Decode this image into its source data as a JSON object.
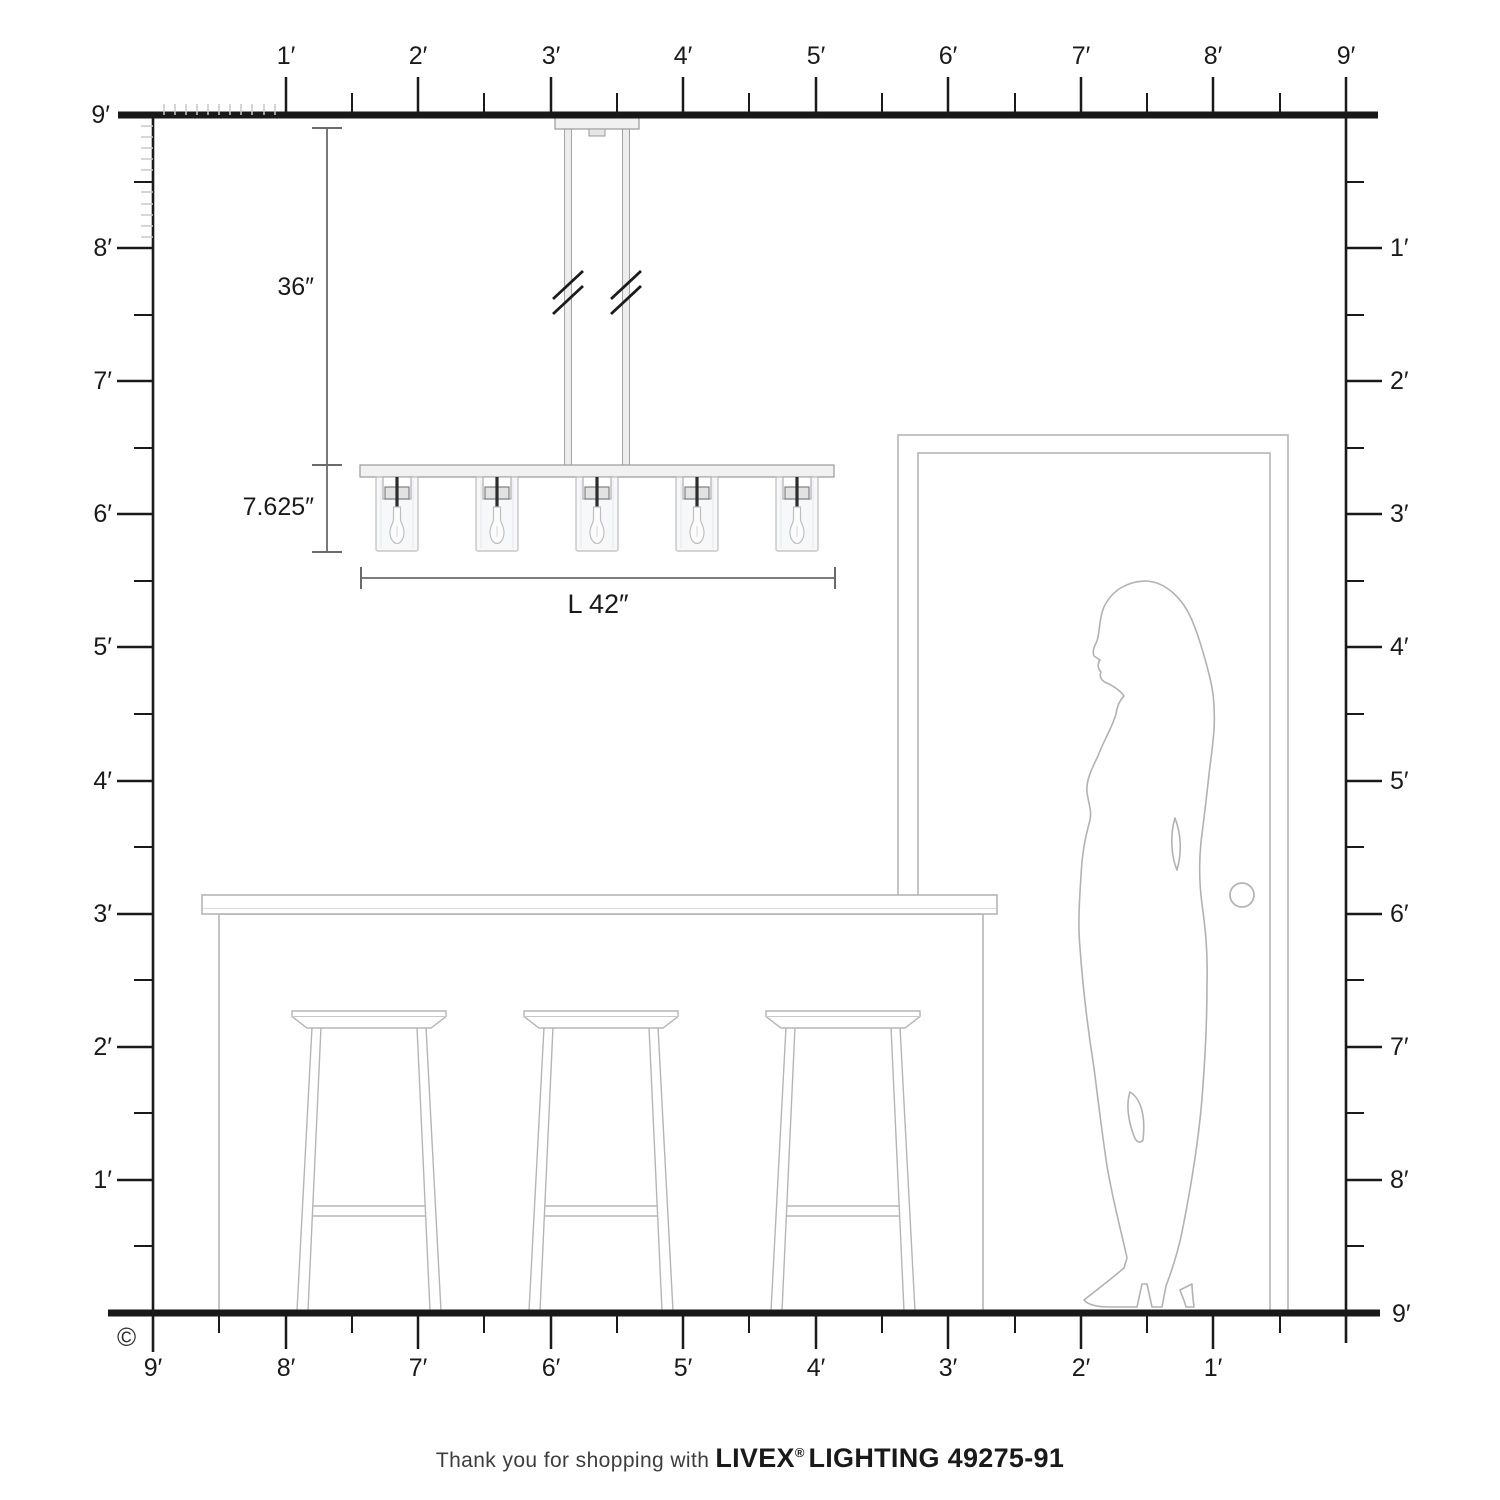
{
  "title": "Lighting fixture scale diagram",
  "rulers": {
    "unit": "feet",
    "max_feet": 9,
    "top": [
      "1′",
      "2′",
      "3′",
      "4′",
      "5′",
      "6′",
      "7′",
      "8′",
      "9′"
    ],
    "left": [
      "9′",
      "8′",
      "7′",
      "6′",
      "5′",
      "4′",
      "3′",
      "2′",
      "1′"
    ],
    "right": [
      "1′",
      "2′",
      "3′",
      "4′",
      "5′",
      "6′",
      "7′",
      "8′",
      "9′"
    ],
    "bottom": [
      "9′",
      "8′",
      "7′",
      "6′",
      "5′",
      "4′",
      "3′",
      "2′",
      "1′"
    ]
  },
  "fixture": {
    "type": "5-light linear chandelier",
    "lights": 5,
    "drop_label": "36″",
    "height_label": "7.625″",
    "length_label": "L 42″"
  },
  "scene": {
    "furniture": [
      "kitchen island",
      "bar stool",
      "bar stool",
      "bar stool",
      "door",
      "woman silhouette"
    ]
  },
  "footer": {
    "prefix": "Thank you for shopping with",
    "brand": "LIVEX",
    "registered": "®",
    "product": "LIGHTING 49275-91"
  },
  "copyright": "©",
  "colors": {
    "ink": "#1a1a1a",
    "dim_line": "#6a6a6a",
    "furniture_outline": "#b5b5b5",
    "figure_outline": "#b2b2b2",
    "inch_tick": "#c9c9c9",
    "metal_light": "#f1f1f1",
    "metal_band": "#e2e2e2",
    "glass": "#f6f7f9"
  }
}
